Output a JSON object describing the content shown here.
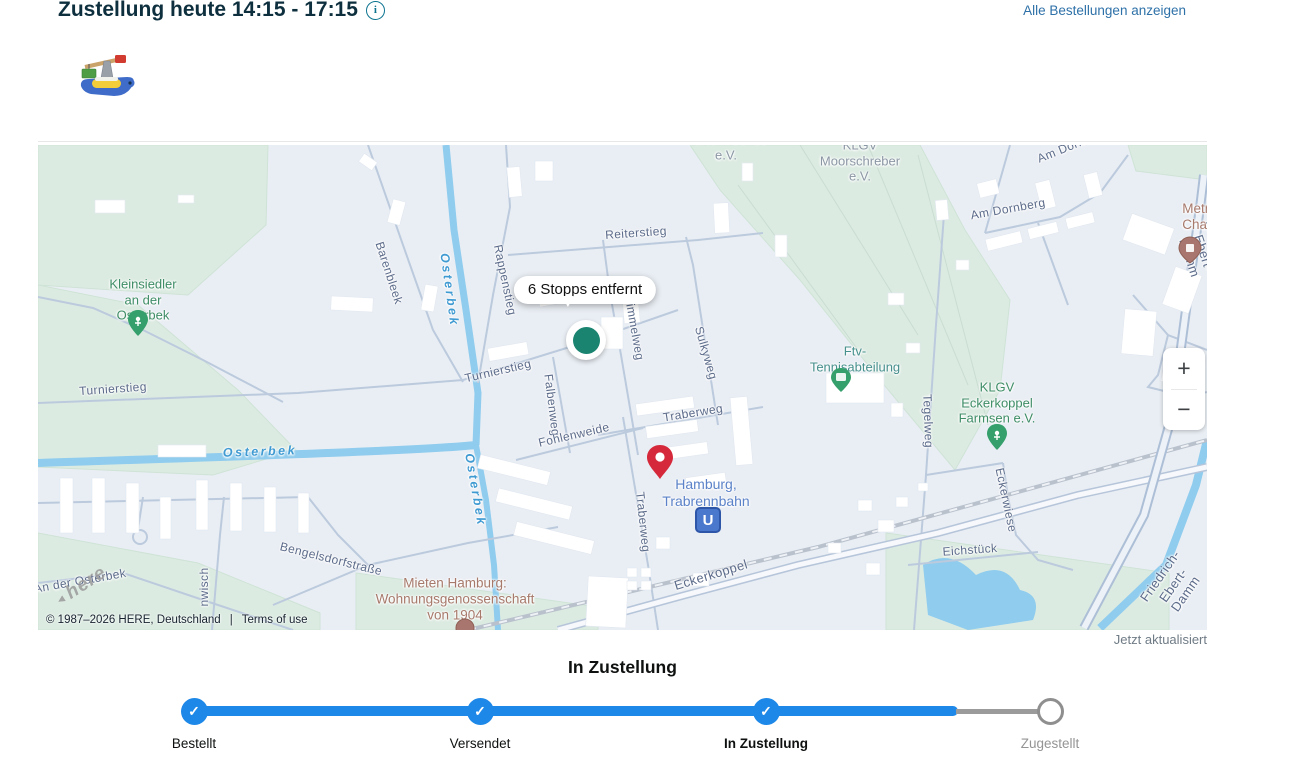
{
  "header": {
    "title": "Zustellung heute 14:15 - 17:15",
    "view_all_orders": "Alle Bestellungen anzeigen"
  },
  "icons": {
    "info": "i",
    "check": "✓",
    "triangle": "▲",
    "plus": "+",
    "minus": "−",
    "product_thumbnail": "toy-crane-boat"
  },
  "map": {
    "tooltip": "6 Stopps entfernt",
    "u_station": "U",
    "watermark": "here",
    "attribution": "© 1987–2026 HERE, Deutschland",
    "separator": "|",
    "terms": "Terms of use",
    "updated": "Jetzt aktualisiert",
    "street_labels": {
      "reiterstieg": "Reiterstieg",
      "rappenstieg": "Rappenstieg",
      "barenbleek": "Barenbleek",
      "turnierstieg": "Turnierstieg",
      "falbenweg": "Falbenweg",
      "himmelweg": "immelweg",
      "sulkyweg": "Sulkyweg",
      "traberweg": "Traberweg",
      "fohlenweide": "Fohlenweide",
      "tegelweg": "Tegelweg",
      "eckerwiese": "Eckerwiese",
      "eichstueck": "Eichstück",
      "eckerkoppel": "Eckerkoppel",
      "friedrich_ebert_damm": "Friedrich-Ebert-Damm",
      "bengelsdorfstrasse": "Bengelsdorfstraße",
      "an_der_osterbek": "An der Osterbek",
      "wisch": "nwisch",
      "am_dornberg": "Am Dornberg"
    },
    "water_labels": {
      "osterbek": "Osterbek"
    },
    "area_labels": {
      "gartenfreunde": "Gartenfreunde\ne.V.",
      "moorschreber": "KLGV\nMoorschreber\ne.V.",
      "kleinsiedler": "Kleinsiedler\nan der\nOsterbek",
      "ftv_tennis": "Ftv-\nTennisabteilung",
      "klgv_eckerkoppel": "KLGV\nEckerkoppel\nFarmsen e.V.",
      "metropolitan": "Metropoli\nChapte",
      "mieten_hamburg": "Mieten Hamburg:\nWohnungsgenossenschaft\nvon 1904",
      "trabrennbahn": "Hamburg,\nTrabrennbahn"
    }
  },
  "tracker": {
    "status_title": "In Zustellung",
    "steps": [
      {
        "label": "Bestellt",
        "state": "done"
      },
      {
        "label": "Versendet",
        "state": "done"
      },
      {
        "label": "In Zustellung",
        "state": "current"
      },
      {
        "label": "Zugestellt",
        "state": "pending"
      }
    ]
  },
  "colors": {
    "progress_blue": "#1d88e8",
    "link_blue": "#2e71a8",
    "title_dark": "#0d2f3e",
    "courier_dot_green": "#1a8470",
    "destination_pin_red": "#d5293b",
    "map_land": "#e9eef4",
    "map_green": "#dcebe2",
    "map_water": "#8fccee"
  }
}
